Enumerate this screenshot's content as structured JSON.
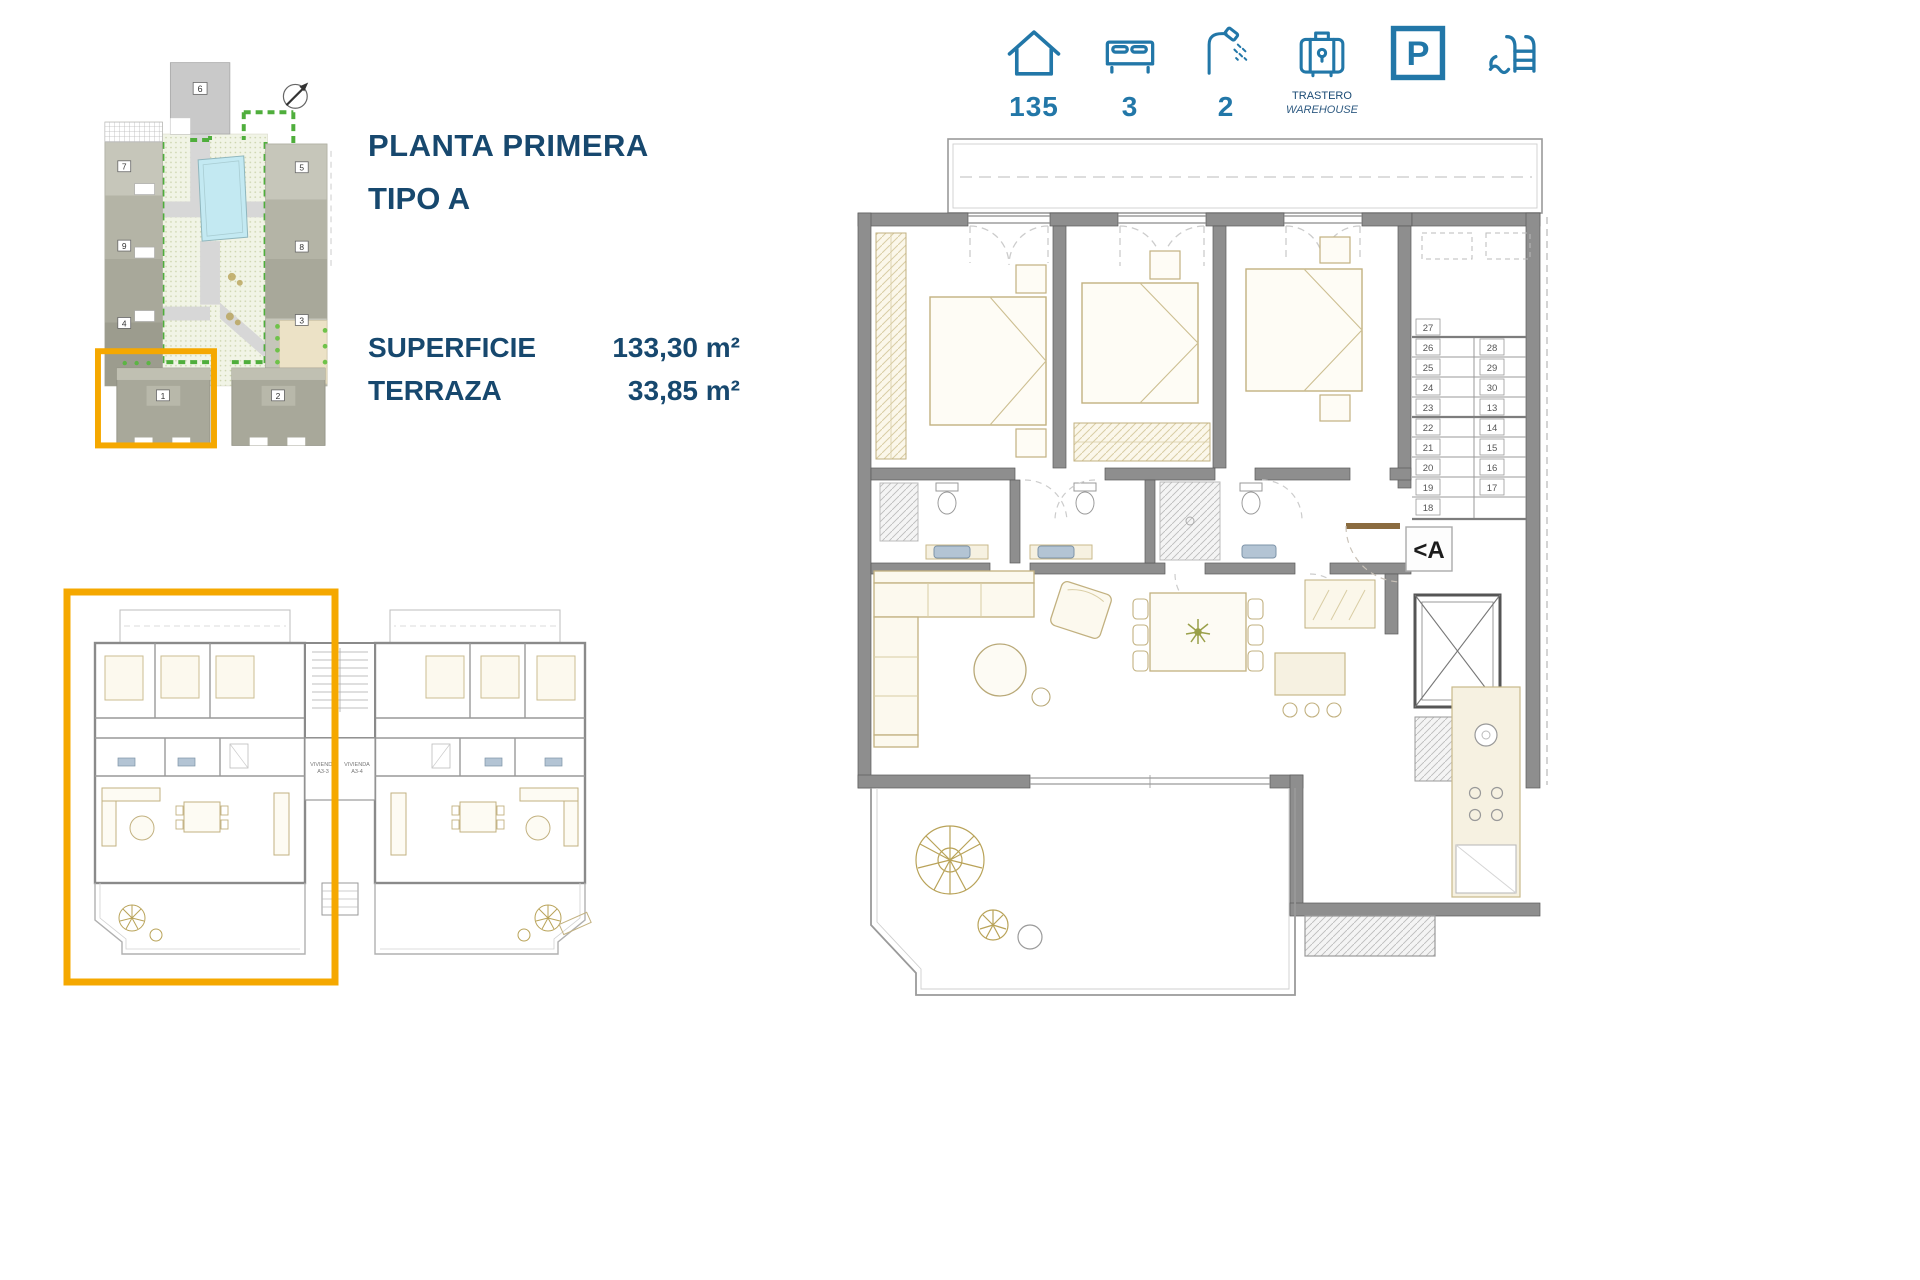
{
  "specs": {
    "area_value": "135",
    "bedrooms_value": "3",
    "bathrooms_value": "2",
    "storage_label_es": "TRASTERO",
    "storage_label_en": "WAREHOUSE",
    "parking_letter": "P"
  },
  "info": {
    "title": "PLANTA PRIMERA",
    "subtitle": "TIPO A",
    "surface_label": "SUPERFICIE",
    "surface_value": "133,30 m²",
    "terrace_label": "TERRAZA",
    "terrace_value": "33,85 m²"
  },
  "site_plan": {
    "buildings": [
      "6",
      "7",
      "8",
      "9",
      "5",
      "4",
      "3",
      "1",
      "2"
    ],
    "highlight_color": "#F5A800"
  },
  "small_plan": {
    "unit_label_left_1": "VIVIENDA",
    "unit_label_left_2": "A3-3",
    "unit_label_right_1": "VIVIENDA",
    "unit_label_right_2": "A3-4"
  },
  "large_plan": {
    "entrance_marker": "<A",
    "stairs_left": [
      "27",
      "26",
      "25",
      "24",
      "23",
      "22",
      "21",
      "20",
      "19",
      "18"
    ],
    "stairs_right": [
      "28",
      "29",
      "30",
      "13",
      "14",
      "15",
      "16",
      "17"
    ]
  },
  "colors": {
    "accent_orange": "#F5A800",
    "navy": "#17486E",
    "icon_blue": "#2277A8"
  }
}
